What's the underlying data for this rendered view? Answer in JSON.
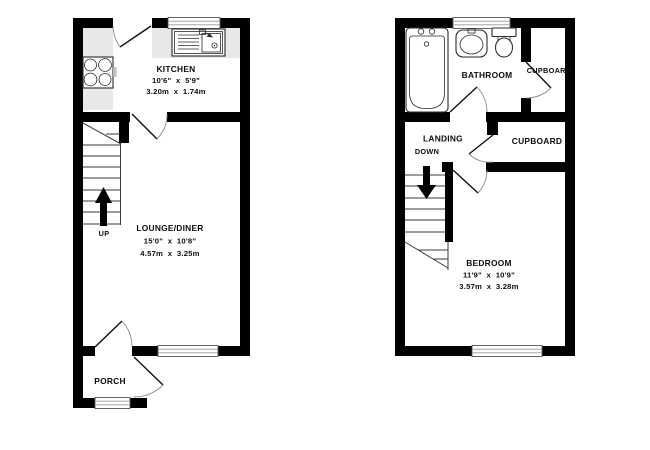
{
  "floorplan": {
    "ground_floor": {
      "kitchen": {
        "name": "KITCHEN",
        "dims_imperial": "10'6\"  x  5'9\"",
        "dims_metric": "3.20m  x  1.74m"
      },
      "lounge": {
        "name": "LOUNGE/DINER",
        "dims_imperial": "15'0\"  x  10'8\"",
        "dims_metric": "4.57m  x  3.25m"
      },
      "porch": {
        "name": "PORCH"
      },
      "stairs_direction": "UP"
    },
    "first_floor": {
      "bathroom": {
        "name": "BATHROOM"
      },
      "cupboard_top": {
        "name": "CUPBOARD"
      },
      "cupboard_mid": {
        "name": "CUPBOARD"
      },
      "landing": {
        "name": "LANDING"
      },
      "bedroom": {
        "name": "BEDROOM",
        "dims_imperial": "11'9\"  x  10'9\"",
        "dims_metric": "3.57m  x  3.28m"
      },
      "stairs_direction": "DOWN"
    },
    "colors": {
      "wall": "#000000",
      "counter": "#e8e8e8",
      "background": "#ffffff"
    }
  }
}
